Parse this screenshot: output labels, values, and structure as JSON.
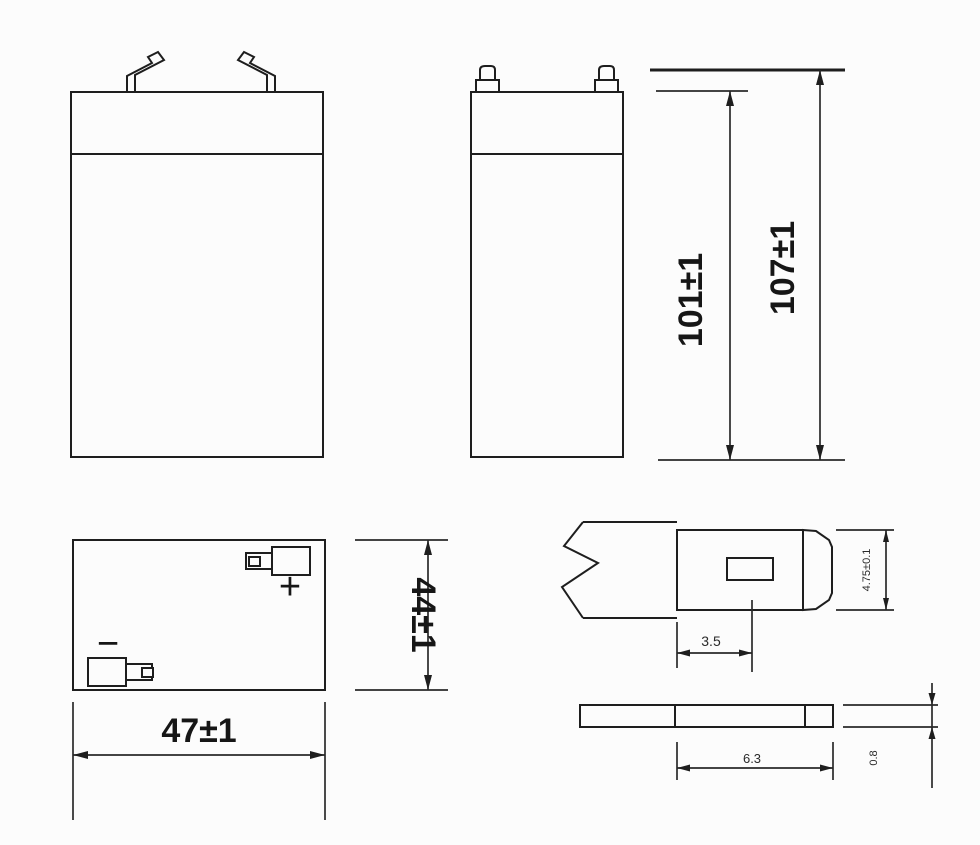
{
  "canvas": {
    "background": "#fcfcfc",
    "line_color": "#1e1e1e"
  },
  "side_view": {
    "dim_case_height": "101±1",
    "dim_overall_height": "107±1"
  },
  "top_view": {
    "dim_depth": "44±1",
    "dim_width": "47±1",
    "positive_label": "+",
    "negative_label": "−"
  },
  "terminal_detail": {
    "dim_tab_width": "4.75±0.1",
    "dim_slot_offset": "3.5",
    "dim_tab_length": "6.3",
    "dim_tab_thickness": "0.8"
  }
}
